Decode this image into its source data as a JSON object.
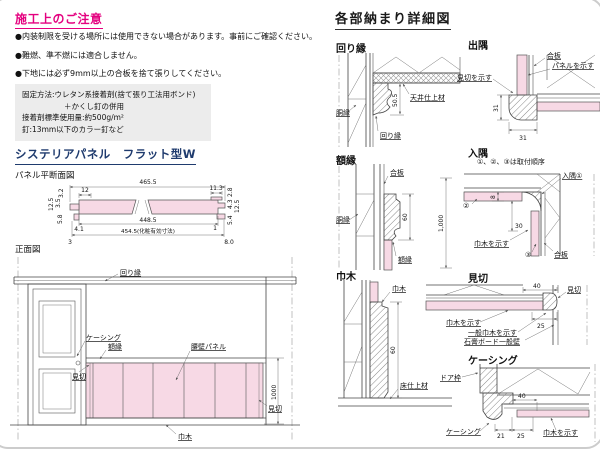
{
  "colors": {
    "accent_pink": "#e4007f",
    "heading_navy": "#1f3b6e",
    "panel_pink": "#f7d9e5",
    "note_box_gray": "#ececec"
  },
  "notes": {
    "title": "施工上のご注意",
    "bullet1": "●内装制限を受ける場所には使用できない場合があります。事前にご確認ください。",
    "bullet2": "●難燃、準不燃には適合しません。",
    "bullet3": "●下地には必ず9mm以上の合板を捨て張りしてください。",
    "box_line1": "固定方法:ウレタン系接着剤(捨て張り工法用ボンド)",
    "box_line2": "＋かくし釘の併用",
    "box_line3": "接着剤標準使用量:約500g/m²",
    "box_line4": "釘:13mm以下のカラー釘など"
  },
  "product": {
    "title": "システリアパネル　フラット型W",
    "plan_label": "パネル平断面図",
    "front_label": "正面図"
  },
  "cs": {
    "w_total": "465.5",
    "v32": "3.2",
    "h12": "12",
    "h113": "11.3",
    "v28": "2.8",
    "v125l": "12.5",
    "v35": "3.5",
    "v58": "5.8",
    "h448": "448.5",
    "w_eff": "454.5(化粧有効寸法)",
    "h41": "4.1",
    "c3": "3",
    "c1": "1",
    "h80": "8.0",
    "v43": "4.3",
    "v125r": "12.5",
    "v54": "5.4"
  },
  "fv": {
    "crown": "回り縁",
    "casing": "ケーシング",
    "frame": "額縁",
    "panel": "腰壁パネル",
    "mikiri_l": "見切",
    "mikiri_r": "見切",
    "habaki": "巾木",
    "dim1000": "1000"
  },
  "d": {
    "title": "各部納まり詳細図",
    "m": {
      "title": "回り縁",
      "dobuchi": "胴縁",
      "ceiling": "天井仕上材",
      "label": "回り縁",
      "dim": "50.5"
    },
    "de": {
      "title": "出隅",
      "gouhan": "合板",
      "panel": "パネルを示す",
      "mikiri": "見切を示す",
      "dim_v": "31",
      "dim_h": "31"
    },
    "g": {
      "title": "額縁",
      "gouhan": "合板",
      "dobuchi": "胴縁",
      "label": "額縁",
      "dim60": "60",
      "dim1000": "1,000"
    },
    "i": {
      "title": "入隅",
      "note": "①、②、③は取付順序",
      "l1": "入隅①",
      "l2": "②",
      "l3": "③",
      "habaki": "巾木を示す",
      "gouhan": "合板",
      "dim8": "8",
      "dim30": "30"
    },
    "h": {
      "title": "巾木",
      "label": "巾木",
      "floor": "床仕上材",
      "dim": "60"
    },
    "mi": {
      "title": "見切",
      "label": "見切",
      "habaki": "巾木を示す",
      "general": "一般巾木を示す",
      "gypsum": "石膏ボード一般壁",
      "dim40": "40",
      "dim25": "25"
    },
    "c": {
      "title": "ケーシング",
      "door": "ドア枠",
      "label": "ケーシング",
      "habaki": "巾木を示す",
      "dim40": "40",
      "dim21": "21",
      "dim25": "25"
    }
  }
}
